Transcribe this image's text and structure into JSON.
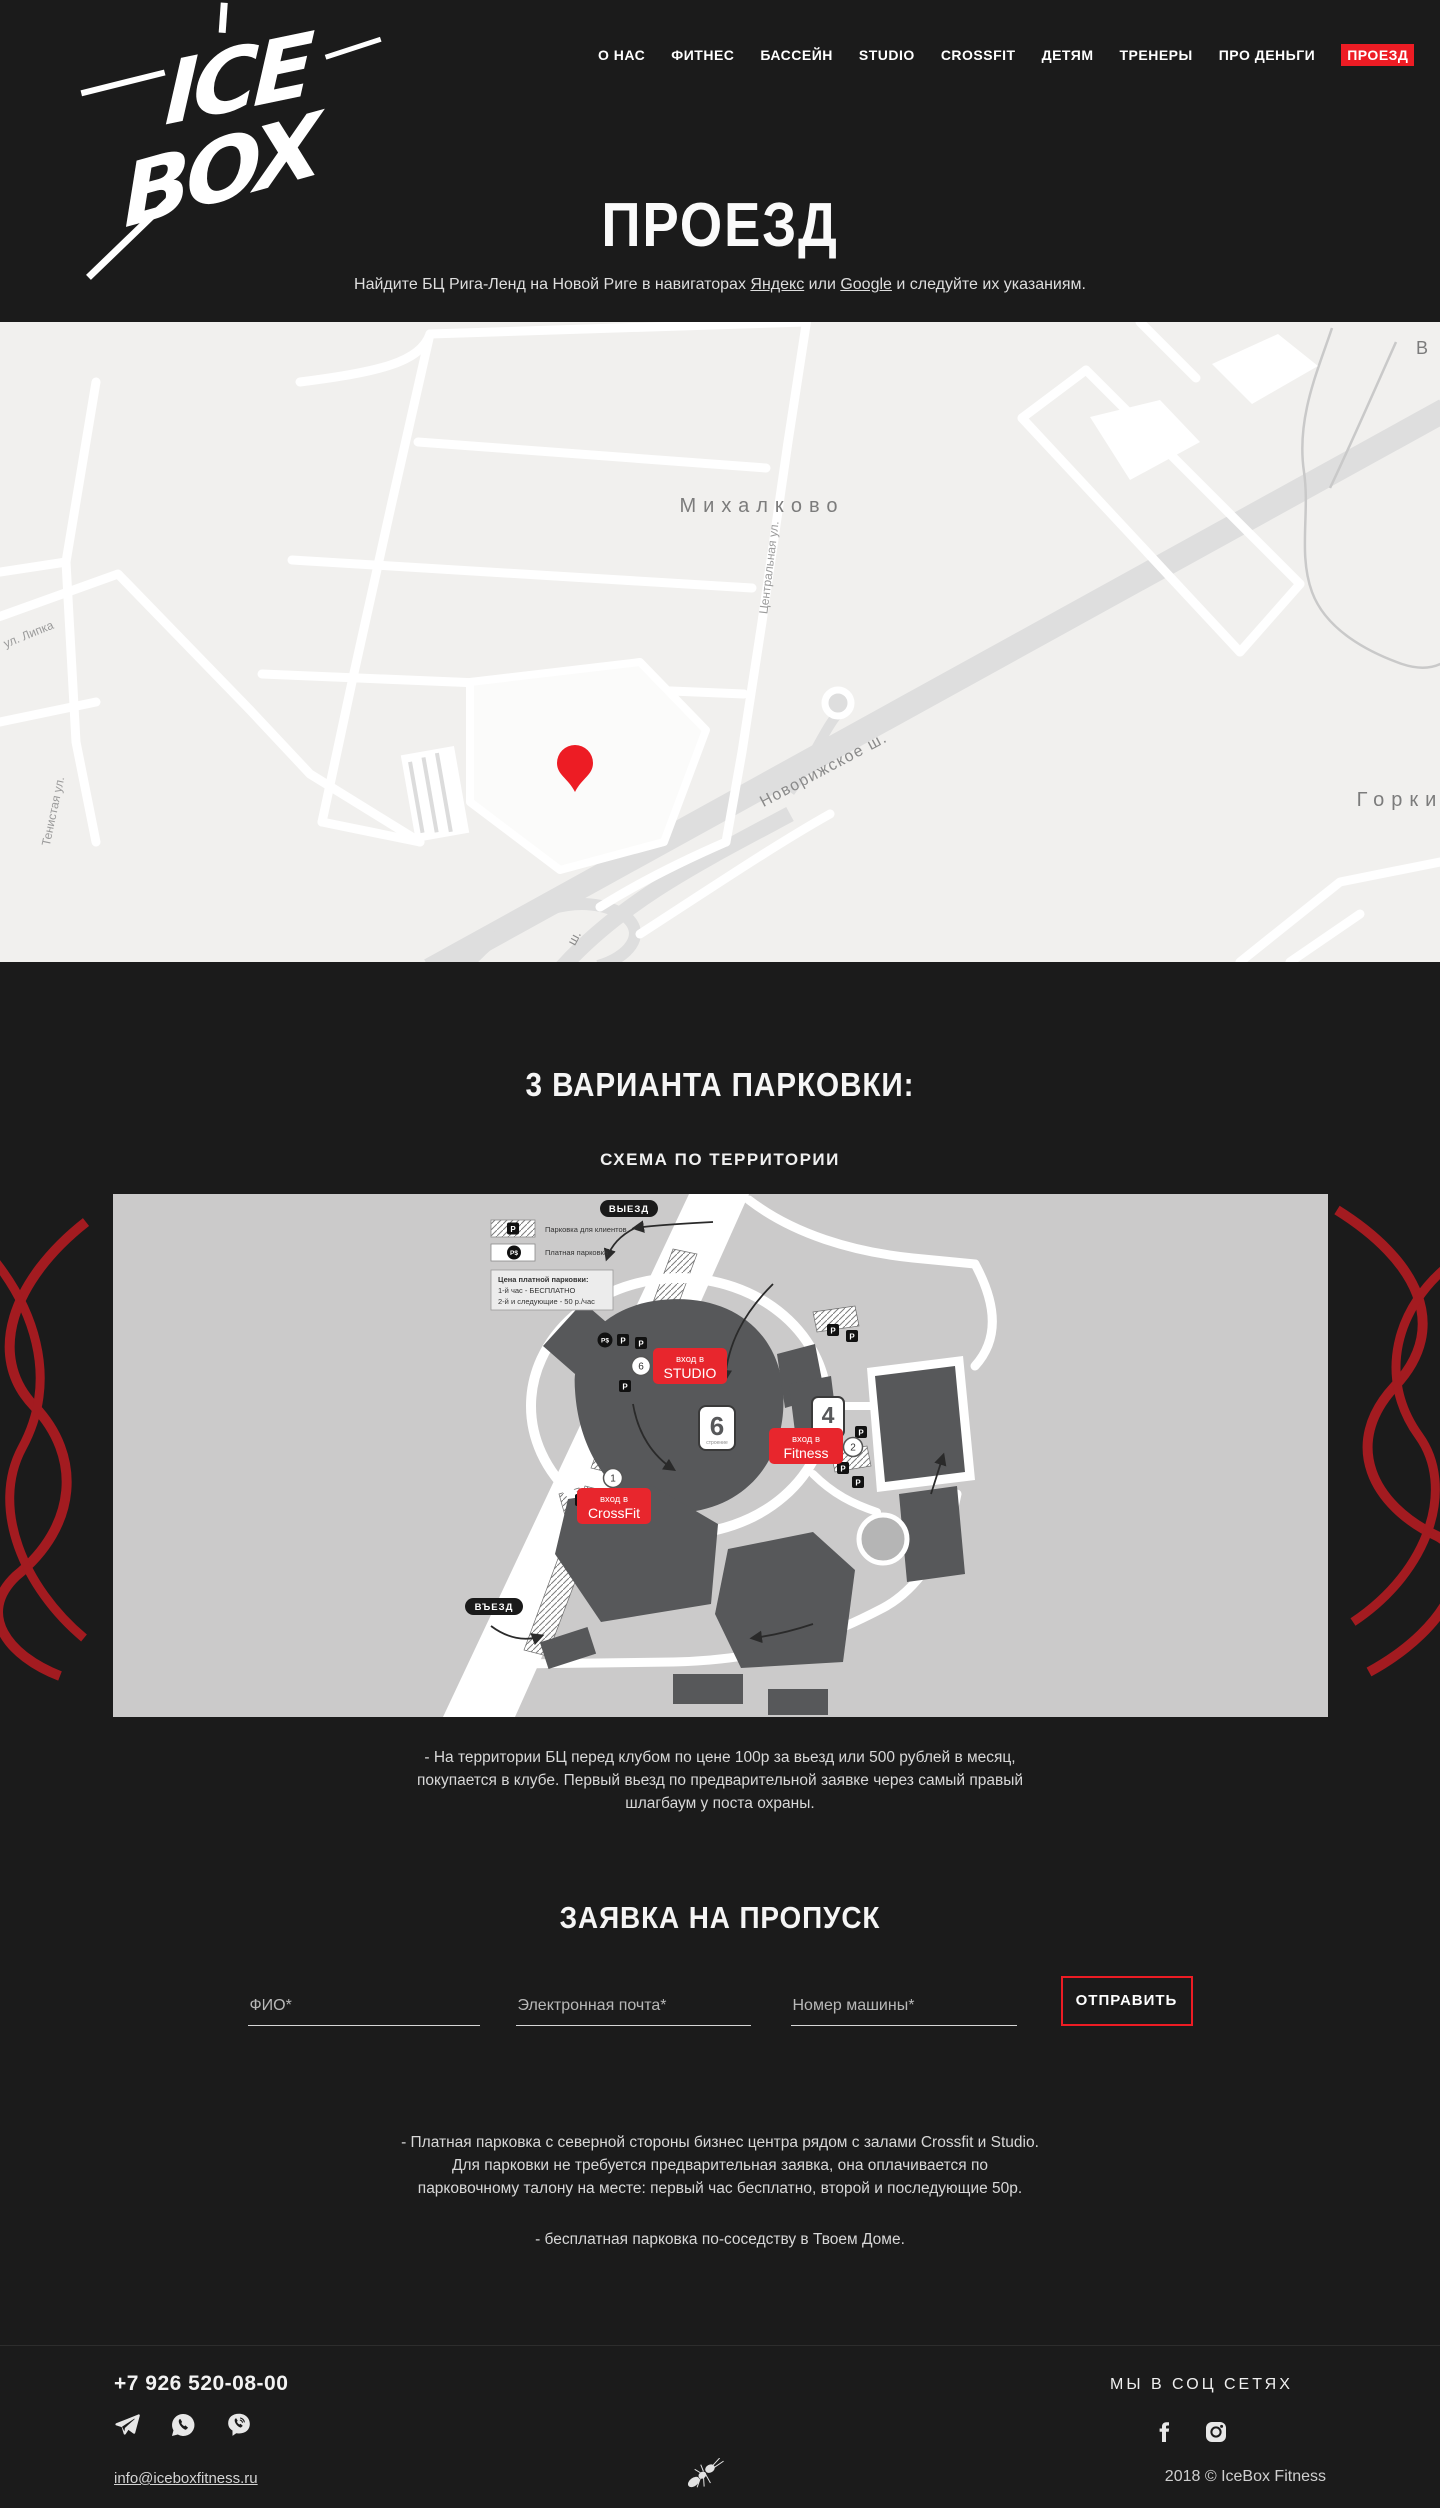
{
  "colors": {
    "accent": "#ed1c24",
    "squiggle": "#a31b20",
    "dark_bg": "#1b1b1b",
    "map_bg": "#f1f0ee",
    "scheme_bg": "#cbcaca",
    "building": "#57585a"
  },
  "header": {
    "logo": {
      "line1": "ICE",
      "line2": "BOX"
    },
    "nav": [
      {
        "label": "О НАС"
      },
      {
        "label": "ФИТНЕС"
      },
      {
        "label": "БАССЕЙН"
      },
      {
        "label": "STUDIO"
      },
      {
        "label": "CROSSFIT"
      },
      {
        "label": "ДЕТЯМ"
      },
      {
        "label": "ТРЕНЕРЫ"
      },
      {
        "label": "ПРО ДЕНЬГИ"
      },
      {
        "label": "ПРОЕЗД",
        "active": true
      }
    ],
    "title": "ПРОЕЗД",
    "subtitle": {
      "before": "Найдите БЦ Рига-Ленд на Новой Риге в навигаторах ",
      "link1": "Яндекс",
      "middle": " или ",
      "link2": "Google",
      "after": " и следуйте их указаниям."
    }
  },
  "map": {
    "labels": {
      "town": "Михалково",
      "street_central": "Центральная ул.",
      "street_tenistaya": "Тенистая ул.",
      "street_lipka": "ул. Липка",
      "highway": "Новорижское ш.",
      "highway_short": "ш.",
      "village_right": "Горки",
      "edge_top_right": "В"
    }
  },
  "parking": {
    "heading": "3 ВАРИАНТА ПАРКОВКИ:",
    "subheading": "СХЕМА ПО ТЕРРИТОРИИ",
    "scheme": {
      "exit_label": "ВЫЕЗД",
      "entry_label": "ВЪЕЗД",
      "p": "P",
      "p_paid": "P$",
      "legend": {
        "client_parking": "Парковка для клиентов",
        "paid_parking": "Платная парковка",
        "price_title": "Цена платной парковки:",
        "price_line1": "1-й час - БЕСПЛАТНО",
        "price_line2": "2-й и следующие - 50 р./час"
      },
      "entrances": {
        "studio": {
          "line1": "вход в",
          "line2": "STUDIO",
          "number": "6"
        },
        "fitness": {
          "line1": "вход в",
          "line2": "Fitness",
          "number": "2"
        },
        "crossfit": {
          "line1": "вход в",
          "line2": "CrossFit",
          "number": "1"
        }
      },
      "buildings": {
        "b6": {
          "number": "6",
          "caption": "строение"
        },
        "b4": {
          "number": "4",
          "caption": "строение"
        }
      }
    },
    "note1": "- На территории БЦ перед клубом  по цене 100р за вьезд или 500 рублей в месяц, покупается в клубе. Первый вьезд по предварительной заявке через самый правый шлагбаум у поста охраны.",
    "note2": "-  Платная парковка с северной стороны бизнес центра рядом с залами Crossfit и Studio.  Для парковки не требуется предварительная заявка, она оплачивается по парковочному талону на месте: первый час бесплатно, второй и последующие 50р.",
    "note3": "-  бесплатная парковка по-соседству  в Твоем Доме."
  },
  "pass_form": {
    "heading": "ЗАЯВКА НА ПРОПУСК",
    "fields": [
      {
        "placeholder": "ФИО*"
      },
      {
        "placeholder": "Электронная почта*"
      },
      {
        "placeholder": "Номер машины*"
      }
    ],
    "submit_label": "ОТПРАВИТЬ"
  },
  "footer": {
    "phone": "+7 926 520-08-00",
    "email": "info@iceboxfitness.ru",
    "social_heading": "МЫ В СОЦ СЕТЯХ",
    "copyright": "2018 © IceBox Fitness"
  }
}
